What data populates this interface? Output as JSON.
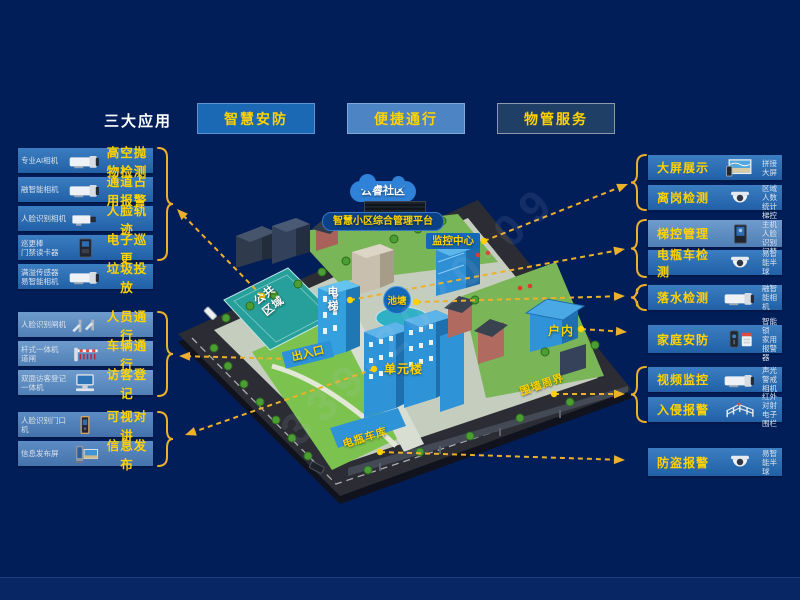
{
  "header": {
    "title": "三大应用",
    "apps": [
      {
        "label": "智慧安防"
      },
      {
        "label": "便捷通行"
      },
      {
        "label": "物管服务"
      }
    ]
  },
  "left_items": [
    {
      "device": "专业AI相机",
      "label": "高空抛物检测",
      "icon": "bullet-camera"
    },
    {
      "device": "融智能相机",
      "label": "通道占用报警",
      "icon": "bullet-camera"
    },
    {
      "device": "人脸识别相机",
      "label": "人脸轨迹",
      "icon": "box-camera"
    },
    {
      "device": "巡更棒\n门禁读卡器",
      "label": "电子巡更",
      "icon": "card-reader"
    },
    {
      "device": "满溢传感器\n易智能相机",
      "label": "垃圾投放",
      "icon": "bullet-camera"
    },
    {
      "device": "人脸识别闸机",
      "label": "人员通行",
      "icon": "turnstile"
    },
    {
      "device": "杆式一体机\n道闸",
      "label": "车辆通行",
      "icon": "barrier-gate"
    },
    {
      "device": "双面访客登记\n一体机",
      "label": "访客登记",
      "icon": "kiosk"
    },
    {
      "device": "人脸识别门口\n机",
      "label": "可视对讲",
      "icon": "door-station"
    },
    {
      "device": "信息发布屏",
      "label": "信息发布",
      "icon": "signage-screen"
    }
  ],
  "right_items": [
    {
      "label": "大屏展示",
      "device": "拼接大屏",
      "icon": "video-wall"
    },
    {
      "label": "离岗检测",
      "device": "区域人数统计",
      "icon": "dome-camera"
    },
    {
      "label": "梯控管理",
      "device": "梯控主机\n人脸识别门禁",
      "icon": "elevator-host"
    },
    {
      "label": "电瓶车检测",
      "device": "易智能半球",
      "icon": "dome-camera"
    },
    {
      "label": "落水检测",
      "device": "融智能相机",
      "icon": "bullet-camera"
    },
    {
      "label": "家庭安防",
      "device": "智能锁\n家用报警器",
      "icon": "smart-lock"
    },
    {
      "label": "视频监控",
      "device": "声光警戒相机",
      "icon": "bullet-camera"
    },
    {
      "label": "入侵报警",
      "device": "红外对射\n电子围栏",
      "icon": "perimeter-fence"
    },
    {
      "label": "防盗报警",
      "device": "易智能半球",
      "icon": "dome-camera"
    }
  ],
  "map": {
    "cloud": "云睿社区",
    "platform": "智慧小区综合管理平台",
    "labels": {
      "monitoring_center": "监控中心",
      "elevator": "电梯",
      "pond": "池塘",
      "public_area": "公共\n区域",
      "entrance": "出入口",
      "unit_building": "单元楼",
      "indoor": "户内",
      "perimeter_wall": "围墙周界",
      "ebike_garage": "电瓶车库"
    }
  },
  "watermark": "339-2020-09",
  "colors": {
    "background": "#011e59",
    "accent_yellow": "#ffd200",
    "arrow_gold": "#edb02a",
    "box_blue": "#2d6cb2",
    "box_blue_light": "#5f8dc5",
    "btn_security": "#1b69b4",
    "btn_passage": "#4d84c4",
    "btn_property": "#203f66"
  }
}
